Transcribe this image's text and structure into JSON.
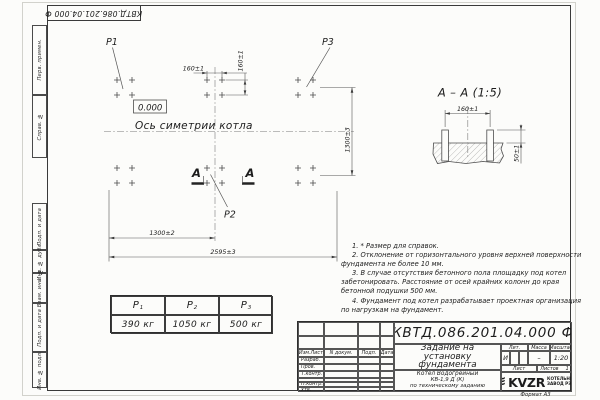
{
  "colors": {
    "paper": "#fcfcfa",
    "ink": "#1c1c1c",
    "line": "#4a4a4a"
  },
  "corner_stamp": "КВТД.086.201.04.000 Ф",
  "side_strip": [
    "Перв. примен.",
    "Справ. №",
    "Подп. и дата",
    "Инв. № дубл.",
    "Взам. инв. №",
    "Подп. и дата",
    "Инв. № подл."
  ],
  "plan": {
    "p1": "P1",
    "p2": "P2",
    "p3": "P3",
    "elevation": "0.000",
    "axis_label": "Ось симетрии котла",
    "section_letter": "А",
    "dim_bolt_x": "160±1",
    "dim_bolt_y": "160±1",
    "dim_rows": "1300±3",
    "dim_half": "1300±2",
    "dim_total": "2595±3",
    "bolt_clusters": {
      "cols": [
        117,
        132,
        207,
        222,
        298,
        313
      ],
      "rows": [
        80,
        95,
        168,
        183
      ]
    }
  },
  "section": {
    "title": "А – А (1:5)",
    "dim_spacing": "160±1",
    "dim_height": "50±1"
  },
  "notes": [
    "1. * Размер для справок.",
    "2. Отклонение от горизонтального уровня верхней поверхности фундамента не более 10 мм.",
    "3. В случае отсутствия бетонного пола площадку под котел забетонировать. Расстояние от осей крайних колонн до края бетонной подушки 500 мм.",
    "4. Фундамент под котел разрабатывает проектная организация по нагрузкам на фундамент."
  ],
  "load_table": {
    "columns": [
      {
        "label": "P",
        "sub": "1",
        "value": "390 кг"
      },
      {
        "label": "P",
        "sub": "2",
        "value": "1050 кг"
      },
      {
        "label": "P",
        "sub": "3",
        "value": "500 кг"
      }
    ]
  },
  "title_block": {
    "doc_number": "КВТД.086.201.04.000 Ф",
    "rev_headers": [
      "Изм.Лист",
      "N докум.",
      "Подп.",
      "Дата"
    ],
    "sign_rows": [
      "Разраб.",
      "Пров.",
      "Т.контр.",
      "",
      "Н.контр.",
      "Утв."
    ],
    "title_lines": [
      "Задание на",
      "установку",
      "фундамента"
    ],
    "product_lines": [
      "Котел Водогрейный",
      "КВ-1,9 Д (К)",
      "по техническому заданию"
    ],
    "lit_label": "Лит.",
    "lit_value": "И",
    "mass_label": "Масса",
    "mass_value": "–",
    "scale_label": "Масштаб",
    "scale_value": "1:20",
    "sheet_label": "Лист",
    "sheets_label": "Листов",
    "sheets_value": "1",
    "logo_text": "KVZR",
    "logo_name_lines": [
      "КОТЕЛЬНЫЙ",
      "ЗАВОД РЭП"
    ],
    "format_label": "Формат А3"
  }
}
